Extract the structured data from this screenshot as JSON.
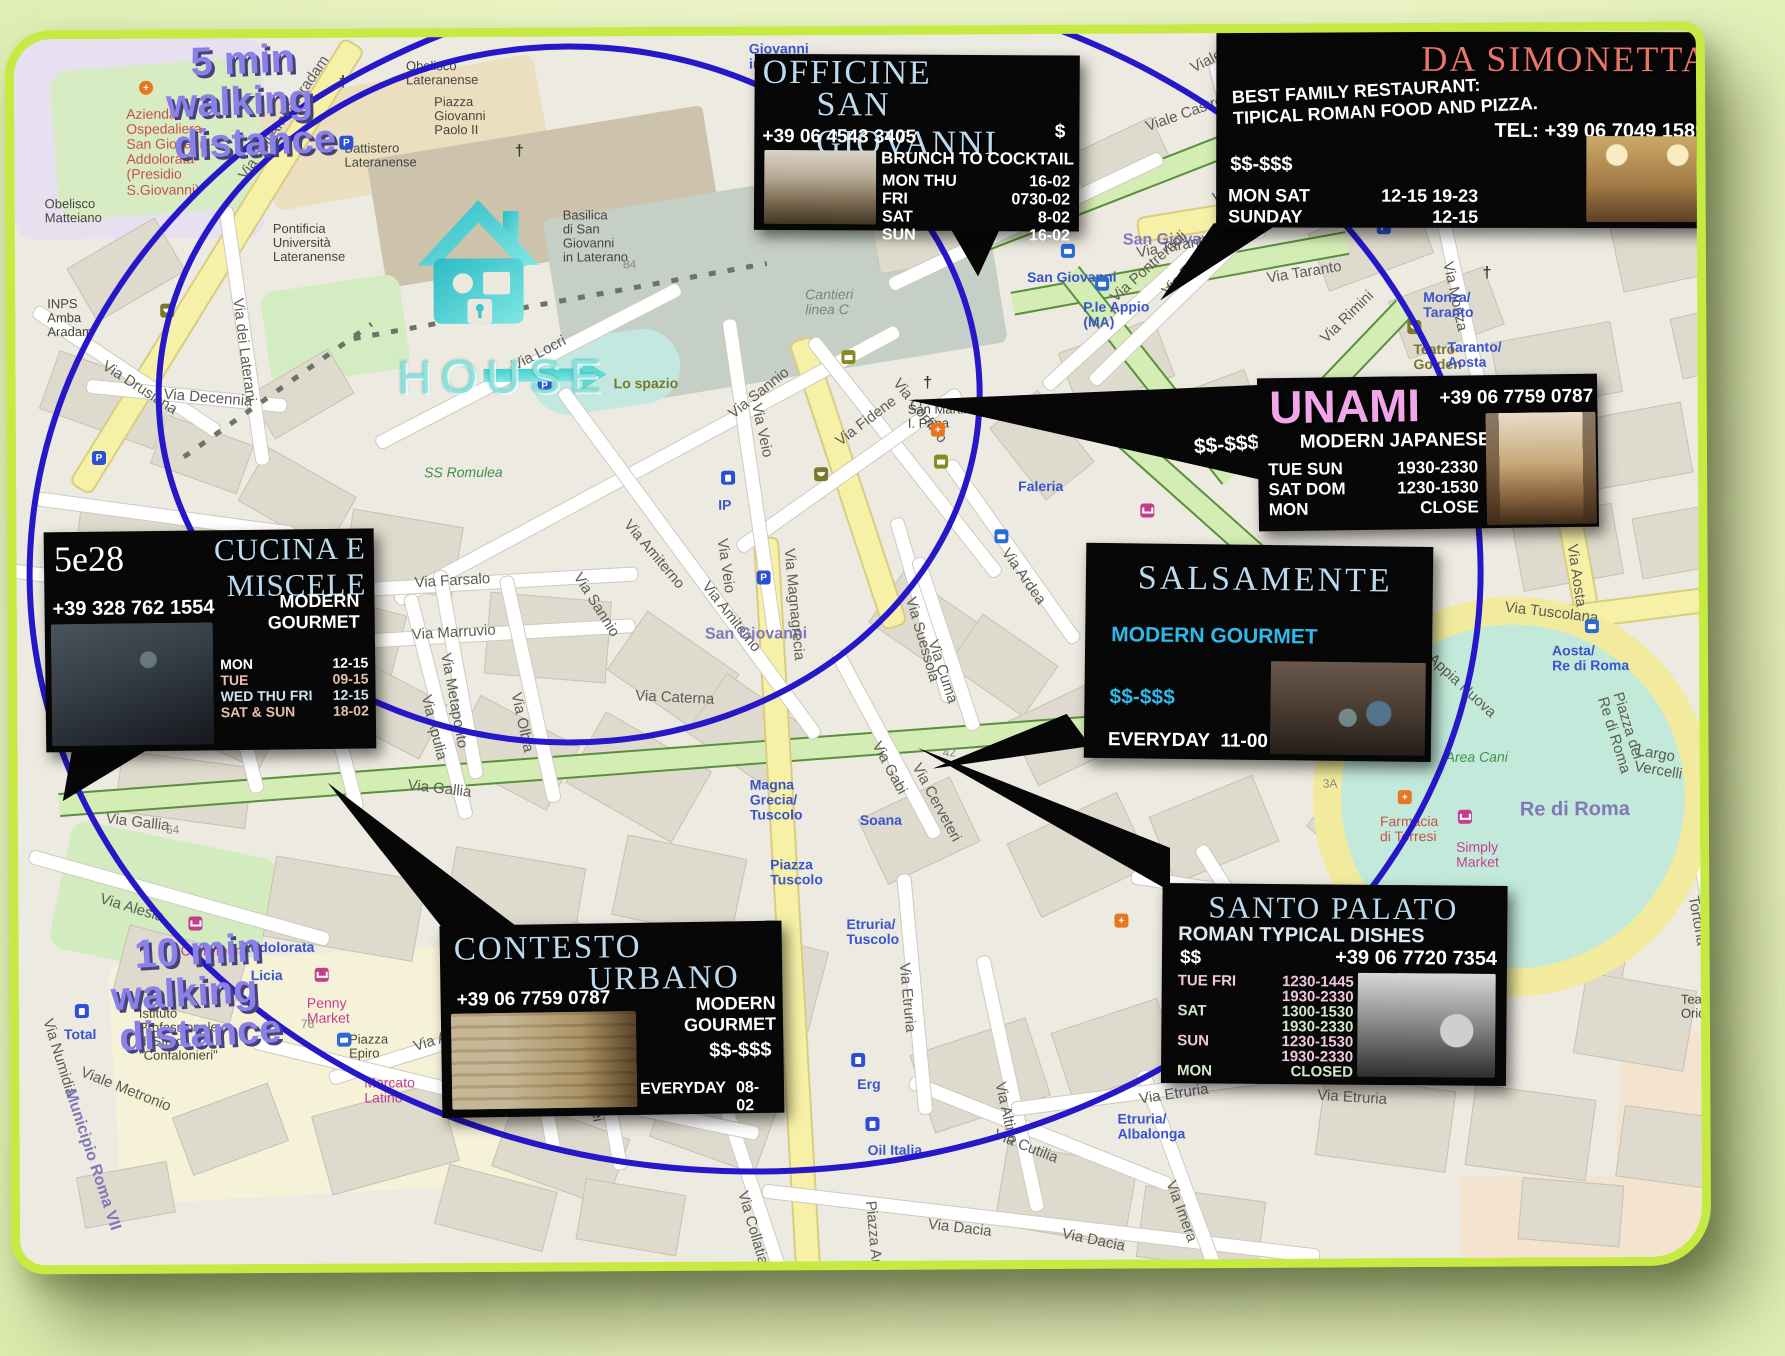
{
  "colors": {
    "lime_border": "#c6ea42",
    "circle_blue": "#2617c9",
    "title_blue": "#bcdaee",
    "simonetta_red": "#e8756a",
    "unami_pink": "#f2a6ea",
    "cyan": "#2fb9e8",
    "walk_purple": "#8b80e8"
  },
  "overlay": {
    "five_min": {
      "lines": [
        "5 min",
        "walking",
        "distance"
      ]
    },
    "ten_min": {
      "lines": [
        "10 min",
        "walking",
        "distance"
      ]
    },
    "house_label": "HOUSE"
  },
  "restaurants": {
    "officine": {
      "title1": "OFFICINE",
      "title2": "SAN GIOVANNI",
      "phone": "+39 06 4543 3405",
      "price": "$",
      "tagline": "FROM BRUNCH TO COCKTAIL",
      "hours": [
        {
          "d": "MON THU",
          "v": "16-02",
          "c": "wh"
        },
        {
          "d": "FRI",
          "v": "0730-02",
          "c": "wh"
        },
        {
          "d": "SAT",
          "v": "8-02",
          "c": "wh"
        },
        {
          "d": "SUN",
          "v": "16-02",
          "c": "wh"
        }
      ]
    },
    "simonetta": {
      "title": "DA SIMONETTA",
      "desc": "BEST FAMILY RESTAURANT:\nTIPICAL ROMAN FOOD AND PIZZA.",
      "tel": "TEL: +39 06 7049 1589",
      "price": "$$-$$$",
      "hours": [
        {
          "d": "MON SAT",
          "v": "12-15 19-23",
          "c": "wh"
        },
        {
          "d": "SUNDAY",
          "v": "12-15",
          "c": "wh"
        }
      ]
    },
    "unami": {
      "title": "UNAMI",
      "phone": "+39 06 7759 0787",
      "cuisine": "MODERN JAPANESE",
      "price": "$$-$$$",
      "hours": [
        {
          "d": "TUE SUN",
          "v": "1930-2330",
          "c": "wh"
        },
        {
          "d": "SAT DOM",
          "v": "1230-1530",
          "c": "wh"
        },
        {
          "d": "MON",
          "v": "CLOSE",
          "c": "wh"
        }
      ]
    },
    "cucina528": {
      "number": "5e28",
      "title": "CUCINA E\nMISCELE",
      "phone": "+39 328 762 1554",
      "cuisine": "MODERN\nGOURMET",
      "hours": [
        {
          "d": "MON",
          "v": "12-15",
          "c": "wh"
        },
        {
          "d": "TUE",
          "v": "09-15",
          "c": "pk2"
        },
        {
          "d": "WED THU FRI",
          "v": "12-15",
          "c": "bl2"
        },
        {
          "d": "SAT & SUN",
          "v": "18-02",
          "c": "pk2"
        }
      ]
    },
    "salsamente": {
      "title": "SALSAMENTE",
      "cuisine": "MODERN GOURMET",
      "price": "$$-$$$",
      "hours": [
        {
          "d": "EVERYDAY",
          "v": "11-00",
          "c": "wh"
        }
      ]
    },
    "contesto": {
      "title1": "CONTESTO",
      "title2": "URBANO",
      "phone": "+39 06 7759 0787",
      "cuisine": "MODERN\nGOURMET",
      "price": "$$-$$$",
      "hours": [
        {
          "d": "EVERYDAY",
          "v": "08-02",
          "c": "wh"
        }
      ]
    },
    "santopalato": {
      "title": "SANTO PALATO",
      "tagline": "ROMAN TYPICAL DISHES",
      "price": "$$",
      "phone": "+39 06 7720 7354",
      "hours": [
        {
          "d": "TUE FRI",
          "v": "1230-1445",
          "c": "pk"
        },
        {
          "d": "",
          "v": "1930-2330",
          "c": "pk"
        },
        {
          "d": "SAT",
          "v": "1300-1530",
          "c": "gr"
        },
        {
          "d": "",
          "v": "1930-2330",
          "c": "gr"
        },
        {
          "d": "SUN",
          "v": "1230-1530",
          "c": "pk"
        },
        {
          "d": "",
          "v": "1930-2330",
          "c": "pk"
        },
        {
          "d": "MON",
          "v": "CLOSED",
          "c": "gr"
        }
      ]
    }
  },
  "map_labels": [
    {
      "t": "Giovanni\nin Laterano",
      "x": 735,
      "y": 6,
      "c": "blue"
    },
    {
      "t": "Azienda\nOspedaliera\nSan Giovanni-\nAddolorata\n(Presidio\nS.Giovanni)",
      "x": 112,
      "y": 68,
      "c": "red"
    },
    {
      "t": "Obelisco\nMatteiano",
      "x": 30,
      "y": 158,
      "c": "dark"
    },
    {
      "t": "Via dell'Amba Aradam",
      "x": 228,
      "y": 132,
      "r": -55
    },
    {
      "t": "Obelisco\nLateranense",
      "x": 392,
      "y": 22,
      "c": "dark"
    },
    {
      "t": "Piazza\nGiovanni\nPaolo II",
      "x": 420,
      "y": 58,
      "c": "dark"
    },
    {
      "t": "Battistero\nLateranense",
      "x": 330,
      "y": 104,
      "c": "dark"
    },
    {
      "t": "Pontificia\nUniversità\nLateranense",
      "x": 258,
      "y": 184,
      "c": "dark"
    },
    {
      "t": "Basilica\ndi San\nGiovanni\nin Laterano",
      "x": 548,
      "y": 172,
      "c": "dark"
    },
    {
      "t": "INPS\nAmba\nAradam",
      "x": 32,
      "y": 258,
      "c": "dark"
    },
    {
      "t": "Via Drusiana",
      "x": 88,
      "y": 318,
      "r": 33
    },
    {
      "t": "Via Decennia",
      "x": 148,
      "y": 348,
      "r": 5
    },
    {
      "t": "Via dei Laterani",
      "x": 222,
      "y": 252,
      "r": 83
    },
    {
      "t": "Cantieri\nlinea C",
      "x": 790,
      "y": 252,
      "c": "gray-it"
    },
    {
      "t": "Lo spazio",
      "x": 598,
      "y": 340,
      "c": "olive"
    },
    {
      "t": "Via Locri",
      "x": 498,
      "y": 322,
      "r": -27
    },
    {
      "t": "Via Sannio",
      "x": 715,
      "y": 372,
      "r": -38
    },
    {
      "t": "Via Sannio",
      "x": 560,
      "y": 530,
      "r": 58
    },
    {
      "t": "Via Corfinio",
      "x": 880,
      "y": 338,
      "r": 52
    },
    {
      "t": "Via Fidene",
      "x": 822,
      "y": 400,
      "r": -37
    },
    {
      "t": "Via Veio",
      "x": 740,
      "y": 360,
      "r": 78
    },
    {
      "t": "Via Veio",
      "x": 705,
      "y": 495,
      "r": 82
    },
    {
      "t": "Via Amiterno",
      "x": 610,
      "y": 478,
      "r": 50
    },
    {
      "t": "Via Amiterno",
      "x": 688,
      "y": 540,
      "r": 52
    },
    {
      "t": "SS Romulea",
      "x": 408,
      "y": 428,
      "c": "green"
    },
    {
      "t": "Via Farsalo",
      "x": 398,
      "y": 538,
      "r": -3
    },
    {
      "t": "Via Marruvio",
      "x": 395,
      "y": 590,
      "r": -3
    },
    {
      "t": "Via Olbia",
      "x": 498,
      "y": 648,
      "r": 78
    },
    {
      "t": "Via Metaponto",
      "x": 428,
      "y": 608,
      "r": 80
    },
    {
      "t": "Via Apulia",
      "x": 408,
      "y": 650,
      "r": 76
    },
    {
      "t": "Via Iliria",
      "x": 198,
      "y": 608,
      "r": 75
    },
    {
      "t": "Via Elea",
      "x": 305,
      "y": 648,
      "r": 75
    },
    {
      "t": "Via Gallia",
      "x": 88,
      "y": 772,
      "r": 7
    },
    {
      "t": "Via Gallia",
      "x": 390,
      "y": 740,
      "r": 7
    },
    {
      "t": "Via Alesia",
      "x": 82,
      "y": 852,
      "r": 17
    },
    {
      "t": "San Giovanni",
      "x": 688,
      "y": 590,
      "c": "purple"
    },
    {
      "t": "Via Magnagrecia",
      "x": 772,
      "y": 505,
      "r": 85
    },
    {
      "t": "Via Ardea",
      "x": 988,
      "y": 508,
      "r": 55
    },
    {
      "t": "Via Suessola",
      "x": 893,
      "y": 555,
      "r": 74
    },
    {
      "t": "Via Cuma",
      "x": 915,
      "y": 598,
      "r": 72
    },
    {
      "t": "Via Caterna",
      "x": 618,
      "y": 652,
      "r": 3
    },
    {
      "t": "Via Gabi",
      "x": 858,
      "y": 700,
      "r": 62
    },
    {
      "t": "Via Cerveteri",
      "x": 898,
      "y": 722,
      "r": 62
    },
    {
      "t": "Via Cerveteri",
      "x": 1075,
      "y": 682,
      "r": 9
    },
    {
      "t": "Faleria",
      "x": 1002,
      "y": 445,
      "c": "blue"
    },
    {
      "t": "San Martino\nI. Papa",
      "x": 892,
      "y": 368,
      "c": "dark"
    },
    {
      "t": "San Giovanni",
      "x": 1012,
      "y": 236,
      "c": "blue"
    },
    {
      "t": "P.le Appio\n(MA)",
      "x": 1068,
      "y": 266,
      "c": "blue"
    },
    {
      "t": "San Giovanni",
      "x": 1108,
      "y": 198,
      "c": "purple"
    },
    {
      "t": "Via Taranto",
      "x": 1122,
      "y": 212,
      "r": -10
    },
    {
      "t": "Via Taranto",
      "x": 1252,
      "y": 238,
      "r": -9
    },
    {
      "t": "Via Faenza",
      "x": 1150,
      "y": 252,
      "r": -45
    },
    {
      "t": "Via Pontremoli",
      "x": 1098,
      "y": 258,
      "r": -42
    },
    {
      "t": "Viale Castrense",
      "x": 1132,
      "y": 86,
      "r": -19
    },
    {
      "t": "Viale Manlio",
      "x": 1178,
      "y": 28,
      "r": -27
    },
    {
      "t": "Via Altamura",
      "x": 1208,
      "y": 82,
      "r": 80
    },
    {
      "t": "Via La Spezia",
      "x": 1198,
      "y": 158,
      "r": -10
    },
    {
      "t": "Asl Roma\n2",
      "x": 1405,
      "y": 20,
      "c": "dark"
    },
    {
      "t": "Via Rimini",
      "x": 1308,
      "y": 300,
      "r": -44
    },
    {
      "t": "Teatro\nGolden",
      "x": 1398,
      "y": 310,
      "c": "olive"
    },
    {
      "t": "Via Monza",
      "x": 1432,
      "y": 222,
      "r": 78
    },
    {
      "t": "Monza/\nTaranto",
      "x": 1408,
      "y": 258,
      "c": "blue"
    },
    {
      "t": "Taranto/\nAosta",
      "x": 1432,
      "y": 308,
      "c": "blue"
    },
    {
      "t": "Carrefour\nExpress",
      "x": 1312,
      "y": 432,
      "c": "mag"
    },
    {
      "t": "Via Casoria",
      "x": 1438,
      "y": 428,
      "r": -8
    },
    {
      "t": "Via Aosta",
      "x": 1555,
      "y": 505,
      "r": 82
    },
    {
      "t": "Via Tuscolana",
      "x": 1488,
      "y": 568,
      "r": 7
    },
    {
      "t": "Aosta/\nRe di Roma",
      "x": 1535,
      "y": 612,
      "c": "blue"
    },
    {
      "t": "Piazza dei Re di Roma",
      "x": 1592,
      "y": 648,
      "r": 73
    },
    {
      "t": "Largo Vercelli",
      "x": 1618,
      "y": 712,
      "r": 10
    },
    {
      "t": "Via Appia Nuova",
      "x": 1225,
      "y": 540,
      "r": 44
    },
    {
      "t": "Via Appia Nuova",
      "x": 1395,
      "y": 600,
      "r": 43
    },
    {
      "t": "Area Cani",
      "x": 1428,
      "y": 718,
      "c": "green"
    },
    {
      "t": "Re di Roma",
      "x": 1502,
      "y": 768,
      "c": "purple",
      "s": 20
    },
    {
      "t": "Farmacia\ndi Torresi",
      "x": 1362,
      "y": 782,
      "c": "red"
    },
    {
      "t": "Simply\nMarket",
      "x": 1438,
      "y": 808,
      "c": "mag"
    },
    {
      "t": "Via Domodossola",
      "x": 1305,
      "y": 868,
      "r": 9
    },
    {
      "t": "Via Tortona",
      "x": 1682,
      "y": 848,
      "r": 80
    },
    {
      "t": "Teatro\nOrione",
      "x": 1662,
      "y": 962,
      "c": "dark"
    },
    {
      "t": "Albalonga",
      "x": 1218,
      "y": 942,
      "c": "blue"
    },
    {
      "t": "Casa Patrizia",
      "x": 1282,
      "y": 988,
      "r": 7
    },
    {
      "t": "Via Etruria",
      "x": 1120,
      "y": 1058,
      "r": -8
    },
    {
      "t": "Etruria/\nAlbalonga",
      "x": 1098,
      "y": 1078,
      "c": "blue"
    },
    {
      "t": "Via Etruria",
      "x": 1298,
      "y": 1055,
      "r": 4
    },
    {
      "t": "Via Etruria",
      "x": 885,
      "y": 920,
      "r": 85
    },
    {
      "t": "Etruria/\nTuscolo",
      "x": 828,
      "y": 882,
      "c": "blue"
    },
    {
      "t": "Piazza\nTuscolo",
      "x": 752,
      "y": 822,
      "c": "blue"
    },
    {
      "t": "Magna\nGrecia/\nTuscolo",
      "x": 732,
      "y": 742,
      "c": "blue"
    },
    {
      "t": "Soana",
      "x": 842,
      "y": 778,
      "c": "blue"
    },
    {
      "t": "Erg",
      "x": 838,
      "y": 1042,
      "c": "blue"
    },
    {
      "t": "Oil Italia",
      "x": 848,
      "y": 1108,
      "c": "blue"
    },
    {
      "t": "Via Collatia",
      "x": 722,
      "y": 1148,
      "r": 74
    },
    {
      "t": "Piazza Armenia",
      "x": 850,
      "y": 1158,
      "r": 85
    },
    {
      "t": "Via Dacia",
      "x": 908,
      "y": 1182,
      "r": 7
    },
    {
      "t": "Via Dacia",
      "x": 1042,
      "y": 1192,
      "r": 12
    },
    {
      "t": "Via Cutilia",
      "x": 975,
      "y": 1092,
      "r": 22
    },
    {
      "t": "Via Altino",
      "x": 980,
      "y": 1040,
      "r": 78
    },
    {
      "t": "Via Imera",
      "x": 1150,
      "y": 1140,
      "r": 70
    },
    {
      "t": "Via Numidia",
      "x": 28,
      "y": 972,
      "r": 73
    },
    {
      "t": "Viale Metronio",
      "x": 62,
      "y": 1025,
      "r": 22
    },
    {
      "t": "Municipio Roma VII",
      "x": 50,
      "y": 1042,
      "r": 72,
      "c": "purple"
    },
    {
      "t": "Istituto\nProfessionale\ndi Stato\n\"Confalonieri\"",
      "x": 120,
      "y": 968,
      "c": "dark"
    },
    {
      "t": "Addolorata",
      "x": 222,
      "y": 902,
      "c": "blue"
    },
    {
      "t": "Licia",
      "x": 232,
      "y": 930,
      "c": "blue"
    },
    {
      "t": "Carrefour",
      "x": 162,
      "y": 905,
      "c": "mag"
    },
    {
      "t": "Penny\nMarket",
      "x": 288,
      "y": 958,
      "c": "mag"
    },
    {
      "t": "Total",
      "x": 45,
      "y": 988,
      "c": "blue"
    },
    {
      "t": "Piazza\nEpiro",
      "x": 330,
      "y": 995,
      "c": "dark"
    },
    {
      "t": "Mercato\nLatino",
      "x": 345,
      "y": 1038,
      "c": "mag"
    },
    {
      "t": "Via Aquitania",
      "x": 395,
      "y": 1002,
      "r": -17
    },
    {
      "t": "Via Saturnia",
      "x": 500,
      "y": 980,
      "r": 80
    },
    {
      "t": "Via Pompei",
      "x": 565,
      "y": 1002,
      "r": 80
    },
    {
      "t": "Epiro",
      "x": 475,
      "y": 1045,
      "c": "blue"
    },
    {
      "t": "IP",
      "x": 702,
      "y": 462,
      "c": "blue"
    },
    {
      "t": "84",
      "x": 608,
      "y": 222,
      "c": "tiny"
    },
    {
      "t": "64",
      "x": 148,
      "y": 785,
      "c": "tiny"
    },
    {
      "t": "76",
      "x": 282,
      "y": 980,
      "c": "tiny"
    },
    {
      "t": "29",
      "x": 1252,
      "y": 990,
      "c": "tiny"
    },
    {
      "t": "18\n16A",
      "x": 1262,
      "y": 438,
      "c": "tiny"
    },
    {
      "t": "3A",
      "x": 1305,
      "y": 745,
      "c": "tiny"
    },
    {
      "t": "42",
      "x": 925,
      "y": 712,
      "c": "tiny"
    }
  ],
  "map_pois": [
    {
      "icon": "hospital-cross-icon",
      "x": 125,
      "y": 42
    },
    {
      "icon": "parking-icon",
      "x": 325,
      "y": 98
    },
    {
      "icon": "parking-icon",
      "x": 522,
      "y": 342
    },
    {
      "icon": "parking-icon",
      "x": 76,
      "y": 412
    },
    {
      "icon": "parking-icon",
      "x": 740,
      "y": 535
    },
    {
      "icon": "parking-icon",
      "x": 1362,
      "y": 188
    },
    {
      "icon": "bus-icon",
      "x": 1046,
      "y": 210
    },
    {
      "icon": "bus-icon",
      "x": 1080,
      "y": 243
    },
    {
      "icon": "bus-icon",
      "x": 978,
      "y": 495
    },
    {
      "icon": "bus-icon",
      "x": 745,
      "y": 885
    },
    {
      "icon": "bus-icon",
      "x": 318,
      "y": 995
    },
    {
      "icon": "bus-icon",
      "x": 1568,
      "y": 588
    },
    {
      "icon": "pharmacy-icon",
      "x": 915,
      "y": 388
    },
    {
      "icon": "pharmacy-icon",
      "x": 1096,
      "y": 880
    },
    {
      "icon": "pharmacy-icon",
      "x": 1380,
      "y": 758
    },
    {
      "icon": "fuel-icon",
      "x": 56,
      "y": 965
    },
    {
      "icon": "fuel-icon",
      "x": 705,
      "y": 435
    },
    {
      "icon": "fuel-icon",
      "x": 832,
      "y": 1018
    },
    {
      "icon": "fuel-icon",
      "x": 846,
      "y": 1082
    },
    {
      "icon": "mail-icon",
      "x": 918,
      "y": 420
    },
    {
      "icon": "mail-icon",
      "x": 1250,
      "y": 118
    },
    {
      "icon": "mail-icon",
      "x": 826,
      "y": 315
    },
    {
      "icon": "church-icon",
      "x": 498,
      "y": 108
    },
    {
      "icon": "church-icon",
      "x": 905,
      "y": 342
    },
    {
      "icon": "church-icon",
      "x": 1465,
      "y": 235
    },
    {
      "icon": "church-icon",
      "x": 1678,
      "y": 885
    },
    {
      "icon": "church-icon",
      "x": 322,
      "y": 38
    },
    {
      "icon": "theater-icon",
      "x": 145,
      "y": 265
    },
    {
      "icon": "theater-icon",
      "x": 798,
      "y": 432
    },
    {
      "icon": "theater-icon",
      "x": 1392,
      "y": 288
    },
    {
      "icon": "cart-icon",
      "x": 170,
      "y": 878
    },
    {
      "icon": "cart-icon",
      "x": 296,
      "y": 930
    },
    {
      "icon": "cart-icon",
      "x": 1318,
      "y": 412
    },
    {
      "icon": "cart-icon",
      "x": 1440,
      "y": 778
    },
    {
      "icon": "cart-icon",
      "x": 1124,
      "y": 470
    }
  ]
}
